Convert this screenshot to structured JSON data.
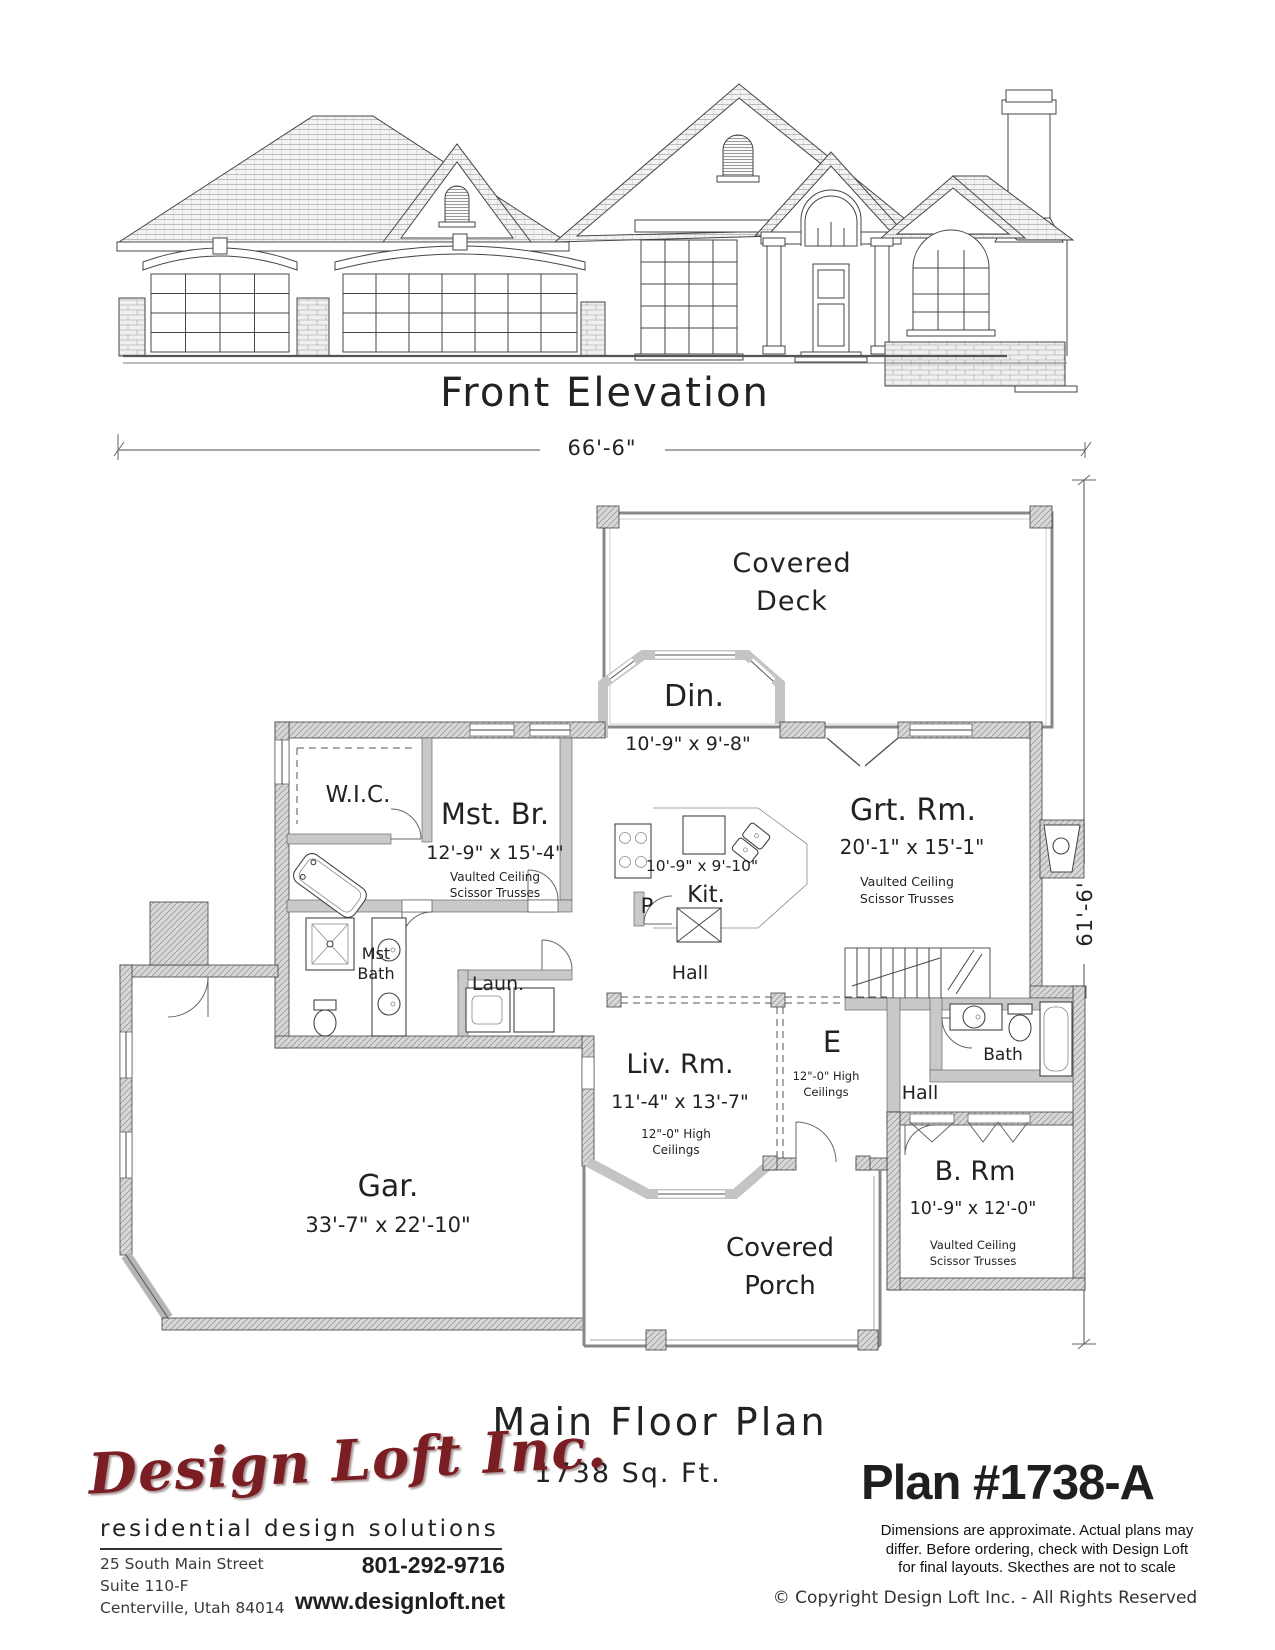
{
  "page": {
    "elevation_title": "Front Elevation",
    "plan_title": "Main Floor Plan",
    "plan_sqft": "1738 Sq. Ft.",
    "plan_number": "Plan #1738-A"
  },
  "dimensions": {
    "overall_width": "66'-6\"",
    "overall_depth": "61'-6'"
  },
  "rooms": {
    "covered_deck": {
      "line1": "Covered",
      "line2": "Deck"
    },
    "dining": {
      "name": "Din.",
      "dims": "10'-9\" x 9'-8\""
    },
    "great_room": {
      "name": "Grt. Rm.",
      "dims": "20'-1\" x 15'-1\"",
      "note1": "Vaulted Ceiling",
      "note2": "Scissor Trusses"
    },
    "wic": {
      "name": "W.I.C."
    },
    "master_bedroom": {
      "name": "Mst. Br.",
      "dims": "12'-9\" x 15'-4\"",
      "note1": "Vaulted Ceiling",
      "note2": "Scissor Trusses"
    },
    "master_bath": {
      "line1": "Mst",
      "line2": "Bath"
    },
    "kitchen": {
      "name": "Kit.",
      "dims": "10'-9\" x 9'-10\""
    },
    "pantry": {
      "name": "P"
    },
    "laundry": {
      "name": "Laun."
    },
    "hall": {
      "name": "Hall"
    },
    "living_room": {
      "name": "Liv. Rm.",
      "dims": "11'-4\" x 13'-7\"",
      "note1": "12\"-0\" High",
      "note2": "Ceilings"
    },
    "entry": {
      "name": "E",
      "note1": "12\"-0\" High",
      "note2": "Ceilings"
    },
    "hall2": {
      "name": "Hall"
    },
    "bath": {
      "name": "Bath"
    },
    "bedroom": {
      "name": "B. Rm",
      "dims": "10'-9\" x 12'-0\"",
      "note1": "Vaulted Ceiling",
      "note2": "Scissor Trusses"
    },
    "garage": {
      "name": "Gar.",
      "dims": "33'-7\" x 22'-10\""
    },
    "covered_porch": {
      "line1": "Covered",
      "line2": "Porch"
    }
  },
  "branding": {
    "company": "Design Loft Inc.",
    "tagline": "residential design solutions",
    "address_line1": "25 South Main Street",
    "address_line2": "Suite 110-F",
    "address_line3": "Centerville, Utah 84014",
    "phone": "801-292-9716",
    "website": "www.designloft.net"
  },
  "legal": {
    "disclaimer_line1": "Dimensions are approximate.  Actual plans may",
    "disclaimer_line2": "differ.  Before ordering, check with Design Loft",
    "disclaimer_line3": "for final layouts.  Skecthes are not to scale",
    "copyright": "©  Copyright Design Loft Inc. - All Rights Reserved"
  },
  "colors": {
    "logo_red": "#7b1e24",
    "line": "#3f3f3f",
    "wall_gray": "#c9c9c9"
  }
}
